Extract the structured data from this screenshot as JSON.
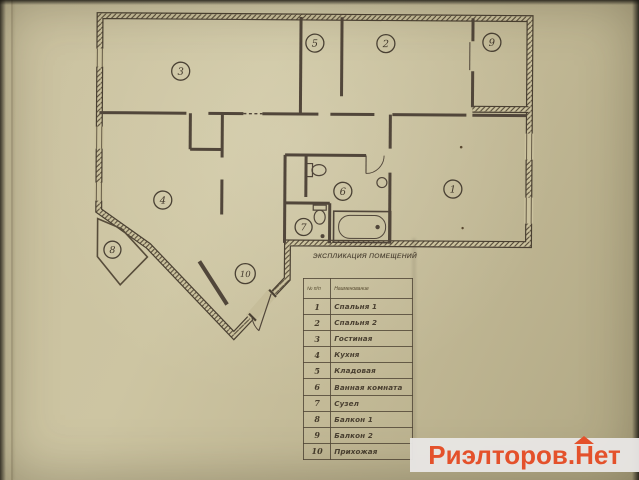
{
  "plan": {
    "markers": [
      {
        "n": "1"
      },
      {
        "n": "2"
      },
      {
        "n": "3"
      },
      {
        "n": "4"
      },
      {
        "n": "5"
      },
      {
        "n": "6"
      },
      {
        "n": "7"
      },
      {
        "n": "8"
      },
      {
        "n": "9"
      },
      {
        "n": "10"
      }
    ]
  },
  "legend": {
    "title": "ЭКСПЛИКАЦИЯ ПОМЕЩЕНИЙ",
    "columns": [
      "№ п/п",
      "Наименование"
    ],
    "rows": [
      {
        "num": "1",
        "name": "Спальня 1"
      },
      {
        "num": "2",
        "name": "Спальня 2"
      },
      {
        "num": "3",
        "name": "Гостиная"
      },
      {
        "num": "4",
        "name": "Кухня"
      },
      {
        "num": "5",
        "name": "Кладовая"
      },
      {
        "num": "6",
        "name": "Ванная комната"
      },
      {
        "num": "7",
        "name": "Сузел"
      },
      {
        "num": "8",
        "name": "Балкон 1"
      },
      {
        "num": "9",
        "name": "Балкон 2"
      },
      {
        "num": "10",
        "name": "Прихожая"
      }
    ]
  },
  "watermark": {
    "part1": "Риэлторов.",
    "house_letter": "Н",
    "part2": "ет",
    "color": "#e4512b",
    "background": "#e7e5e3"
  },
  "colors": {
    "paper": "#c8bf9c",
    "ink": "#51463a"
  }
}
